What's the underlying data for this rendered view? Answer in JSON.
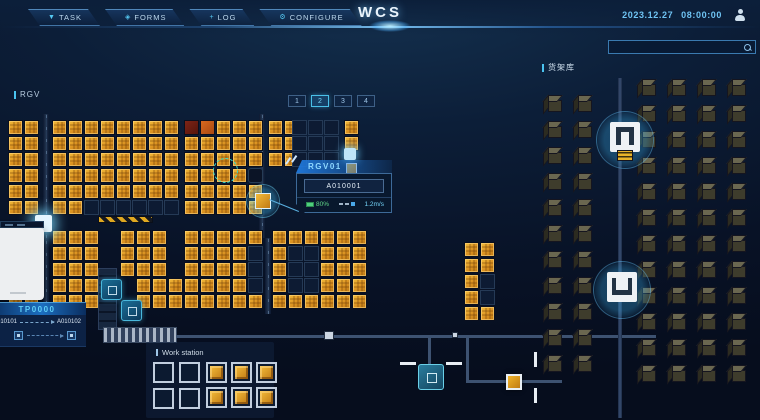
{
  "header": {
    "title": "WCS",
    "tabs": [
      {
        "label": "TASK",
        "icon": "filter-icon",
        "glyph": "▼"
      },
      {
        "label": "FORMS",
        "icon": "forms-icon",
        "glyph": "◈"
      },
      {
        "label": "LOG",
        "icon": "log-icon",
        "glyph": "+"
      },
      {
        "label": "CONFIGURE",
        "icon": "gear-icon",
        "glyph": "⚙"
      }
    ],
    "date": "2023.12.27",
    "time": "08:00:00",
    "search_placeholder": ""
  },
  "map": {
    "area_label": "RGV",
    "pagination": {
      "pages": [
        "1",
        "2",
        "3",
        "4"
      ],
      "active_index": 1
    },
    "popup": {
      "title": "RGV01",
      "code": "A010001",
      "battery": "80%",
      "speed": "1.2m/s"
    },
    "blocks": [
      {
        "x": 8,
        "y": 120,
        "rows": [
          "YY",
          "YY",
          "YY",
          "YY",
          "YY",
          "YY"
        ]
      },
      {
        "x": 52,
        "y": 120,
        "rows": [
          "YYYYYYYY",
          "YYYYYYYY",
          "YYYYYYYY",
          "YYYYYYYY",
          "YYYYYYYY",
          "YYEEEEEE"
        ]
      },
      {
        "x": 184,
        "y": 120,
        "rows": [
          "ROYYY",
          "YYYYY",
          "YYYYY",
          "YYYYD",
          "YYYYY",
          "YYYYY"
        ]
      },
      {
        "x": 268,
        "y": 120,
        "rows": [
          "YY",
          "YY",
          "YY"
        ]
      },
      {
        "x": 292,
        "y": 120,
        "rows": [
          "EEE",
          "EEE",
          "EEE"
        ]
      },
      {
        "x": 344,
        "y": 120,
        "rows": [
          "Y",
          "Y"
        ]
      },
      {
        "x": 8,
        "y": 230,
        "rows": [
          "YY",
          "YY",
          "YY",
          "YY",
          "YY"
        ]
      },
      {
        "x": 52,
        "y": 230,
        "rows": [
          "YYY",
          "YYY",
          "YYY",
          "YYY",
          "YYY"
        ]
      },
      {
        "x": 120,
        "y": 230,
        "rows": [
          "YYY",
          "YYY",
          "YYY"
        ]
      },
      {
        "x": 136,
        "y": 278,
        "rows": [
          "YYY",
          "YYY"
        ]
      },
      {
        "x": 184,
        "y": 230,
        "rows": [
          "YYYYY",
          "YYYYE",
          "YYYYE",
          "YYYYE",
          "YYYYY"
        ]
      },
      {
        "x": 272,
        "y": 230,
        "rows": [
          "YYYYYY",
          "YEEYYY",
          "YEEYYY",
          "YEEYYY",
          "YYYYYY"
        ]
      },
      {
        "x": 464,
        "y": 242,
        "rows": [
          "YY",
          "YY",
          "YE",
          "YE",
          "YY"
        ]
      }
    ]
  },
  "shelf": {
    "label": "货架库",
    "columns": [
      {
        "x": 548,
        "y": 100,
        "count": 11
      },
      {
        "x": 578,
        "y": 100,
        "count": 11
      },
      {
        "x": 642,
        "y": 84,
        "count": 12
      },
      {
        "x": 672,
        "y": 84,
        "count": 12
      },
      {
        "x": 702,
        "y": 84,
        "count": 12
      },
      {
        "x": 732,
        "y": 84,
        "count": 12
      }
    ],
    "lifts": [
      {
        "cx": 625,
        "cy": 140,
        "variant": "carriage"
      },
      {
        "cx": 622,
        "cy": 290,
        "variant": "gate"
      }
    ]
  },
  "tp_panel": {
    "title": "TP0000",
    "from": "A010101",
    "to": "A010102"
  },
  "workstation": {
    "label": "Work station",
    "groups": [
      {
        "x": 153,
        "y": 362,
        "cols": 2,
        "rows": 2,
        "pitch": 26,
        "filled": false
      },
      {
        "x": 206,
        "y": 362,
        "cols": 3,
        "rows": 2,
        "pitch": 25,
        "filled": true
      }
    ]
  },
  "colors": {
    "accent": "#4ac3f0",
    "cell_yellow": "#e2a122",
    "alert_red": "#7a1f12",
    "alert_orange": "#c75a18",
    "battery_green": "#62d88a"
  }
}
